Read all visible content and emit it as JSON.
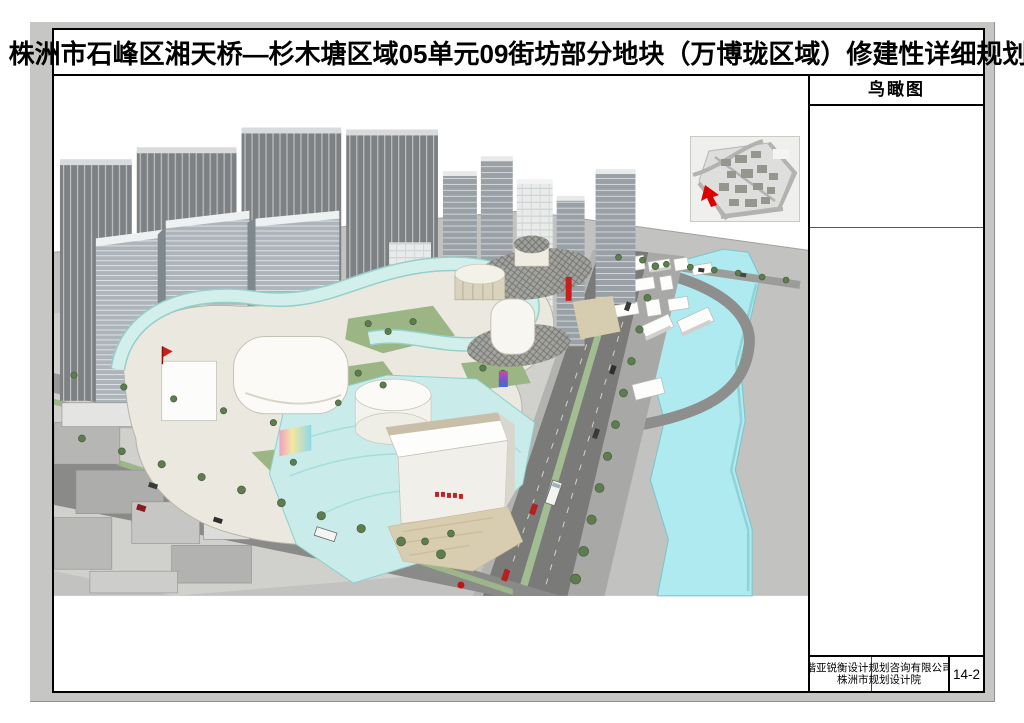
{
  "document": {
    "title": "株洲市石峰区湘天桥—杉木塘区域05单元09街坊部分地块（万博珑区域）修建性详细规划",
    "sidebar": {
      "view_label": "鸟瞰图",
      "title_block": {
        "company_line1": "楷亚锐衡设计规划咨询有限公司",
        "company_line2": "株洲市规划设计院",
        "sheet_number": "14-2"
      }
    },
    "rendering": {
      "type": "aerial-perspective-rendering",
      "accent_colors": {
        "river_cyan": "#aeeaef",
        "glass_ribbon_cyan": "#d2efec",
        "tree_green": "#5e7c50",
        "ground_gray": "#c2c2c0",
        "accent_red": "#cc1c1c"
      }
    }
  }
}
